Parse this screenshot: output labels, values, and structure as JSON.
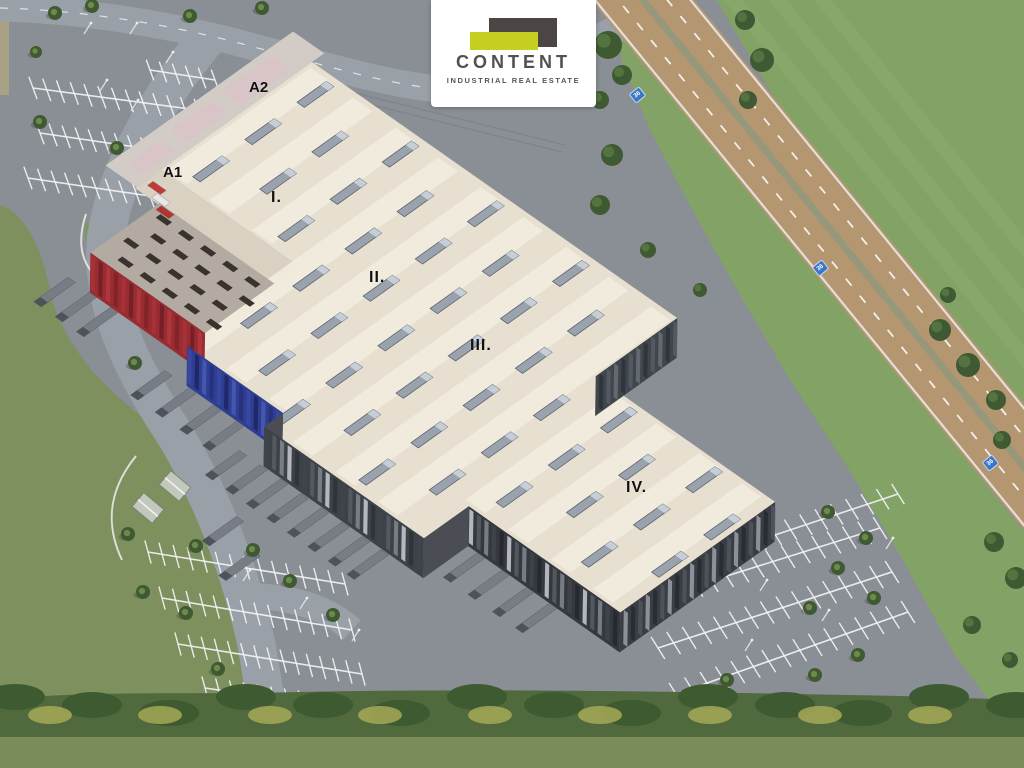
{
  "scene": {
    "title": "Aerial visualisation of Content industrial park"
  },
  "logo": {
    "name": "CONTENT",
    "tagline": "INDUSTRIAL REAL ESTATE"
  },
  "labels": {
    "hall_a1": "A1",
    "hall_a2": "A2",
    "section_1": "I.",
    "section_2": "II.",
    "section_3": "III.",
    "section_4": "IV."
  },
  "highway": {
    "marker": "36"
  },
  "colors": {
    "pavement": "#8a8e95",
    "road": "#9aa0a7",
    "road_line": "#e8e8e8",
    "highway": "#b49670",
    "highway_median": "#95987a",
    "grass": "#83a266",
    "grass_light": "#8fae70",
    "field": "#7d905e",
    "dirt_path": "#c3b28d",
    "veg_dark": "#3d5a31",
    "veg_base": "#50693d",
    "veg_yellow": "#a6a957",
    "veg_light": "#8a9a64",
    "tree": "#3f5a33",
    "tree_light": "#6d8a4a",
    "roof": "#e7dfcf",
    "roof_ridge": "#f2ecdf",
    "roof_low": "#d9d1c1",
    "annex_roof": "#b3aba2",
    "vent": "#3a322d",
    "skylight": "#9aa2ae",
    "skylight_edge": "#5a626e",
    "apron": "#d3ccc6",
    "apron_pink": "#d9c3c7",
    "facade_red": "#982c31",
    "facade_blue": "#2e3f93",
    "facade_dark": "#3d4148",
    "facade_dark2": "#4a4e54",
    "truck": "#787d85",
    "truck_dark": "#4e535a",
    "stripe_white": "#f2f3f4",
    "pole": "#dcdee0",
    "hut": "#c2c8bc",
    "marker_blue": "#3a76c8",
    "logo_dark": "#4b4643",
    "logo_accent": "#c5d022"
  }
}
